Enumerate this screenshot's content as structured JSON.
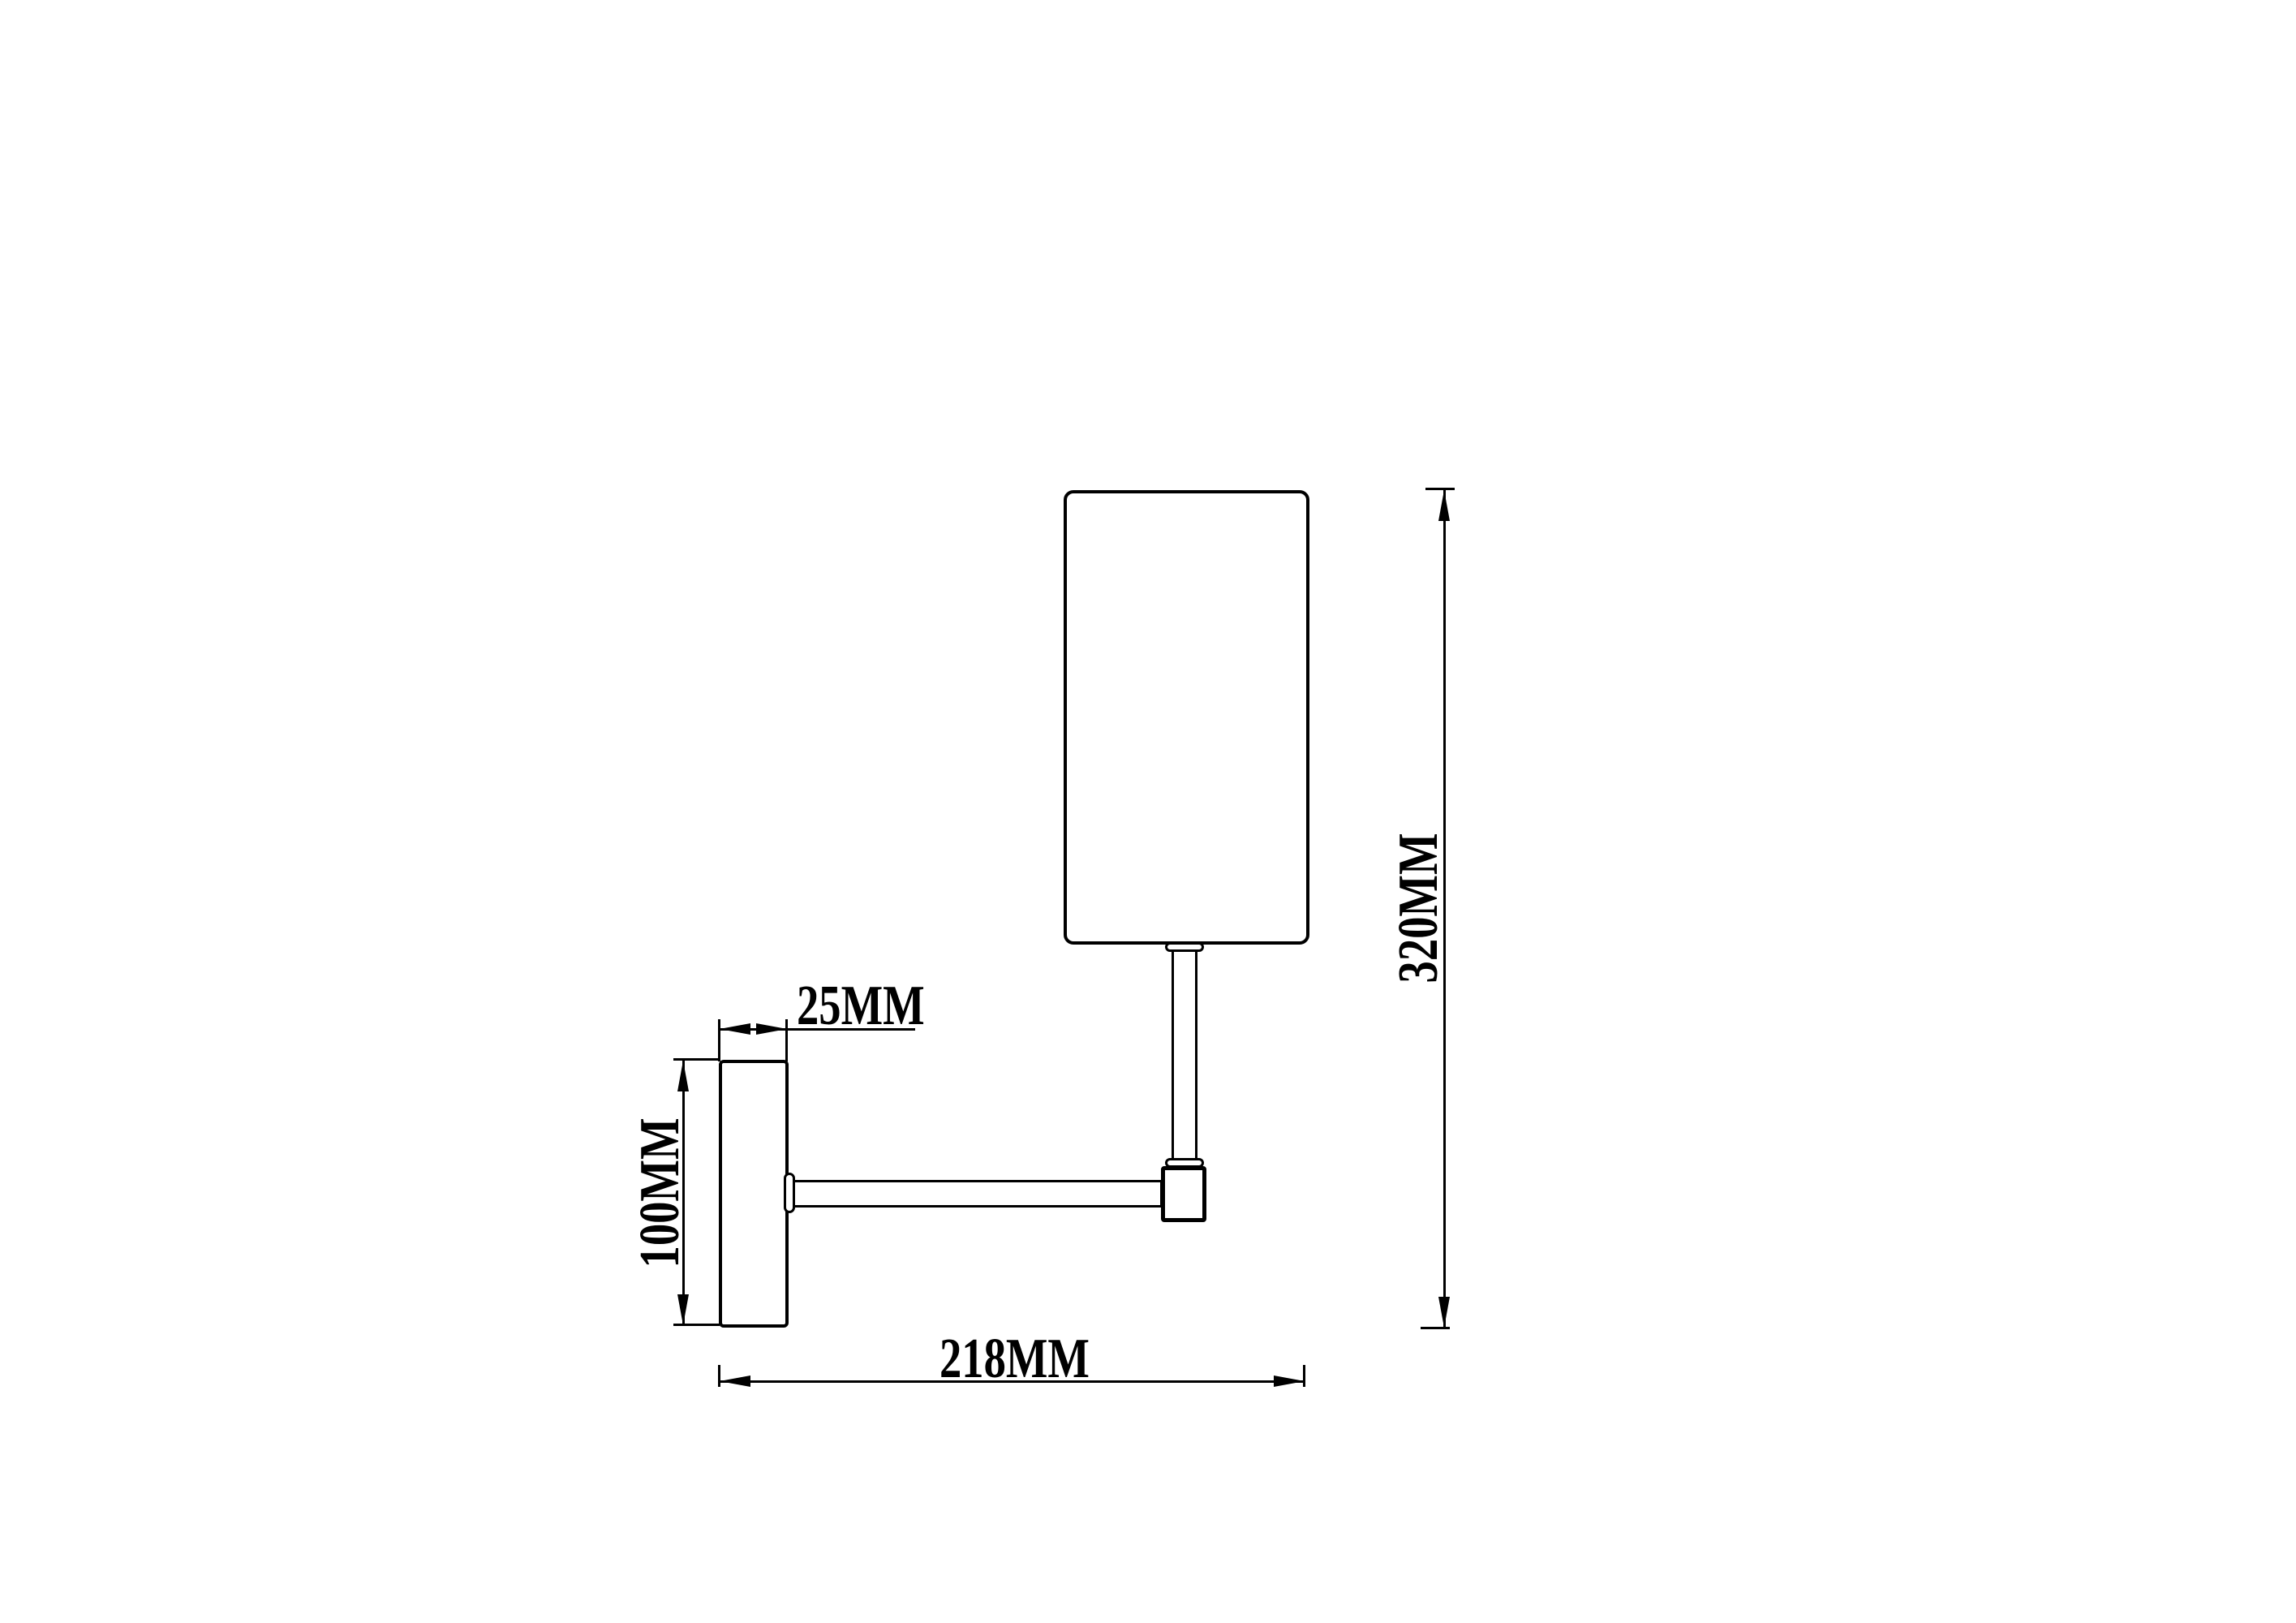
{
  "page": {
    "background_color": "#ffffff",
    "line_color": "#000000"
  },
  "drawing": {
    "dimensions": {
      "plate_depth": {
        "label": "25MM",
        "value": 25,
        "unit": "MM"
      },
      "plate_height": {
        "label": "100MM",
        "value": 100,
        "unit": "MM"
      },
      "projection": {
        "label": "218MM",
        "value": 218,
        "unit": "MM"
      },
      "total_height": {
        "label": "320MM",
        "value": 320,
        "unit": "MM"
      }
    }
  }
}
